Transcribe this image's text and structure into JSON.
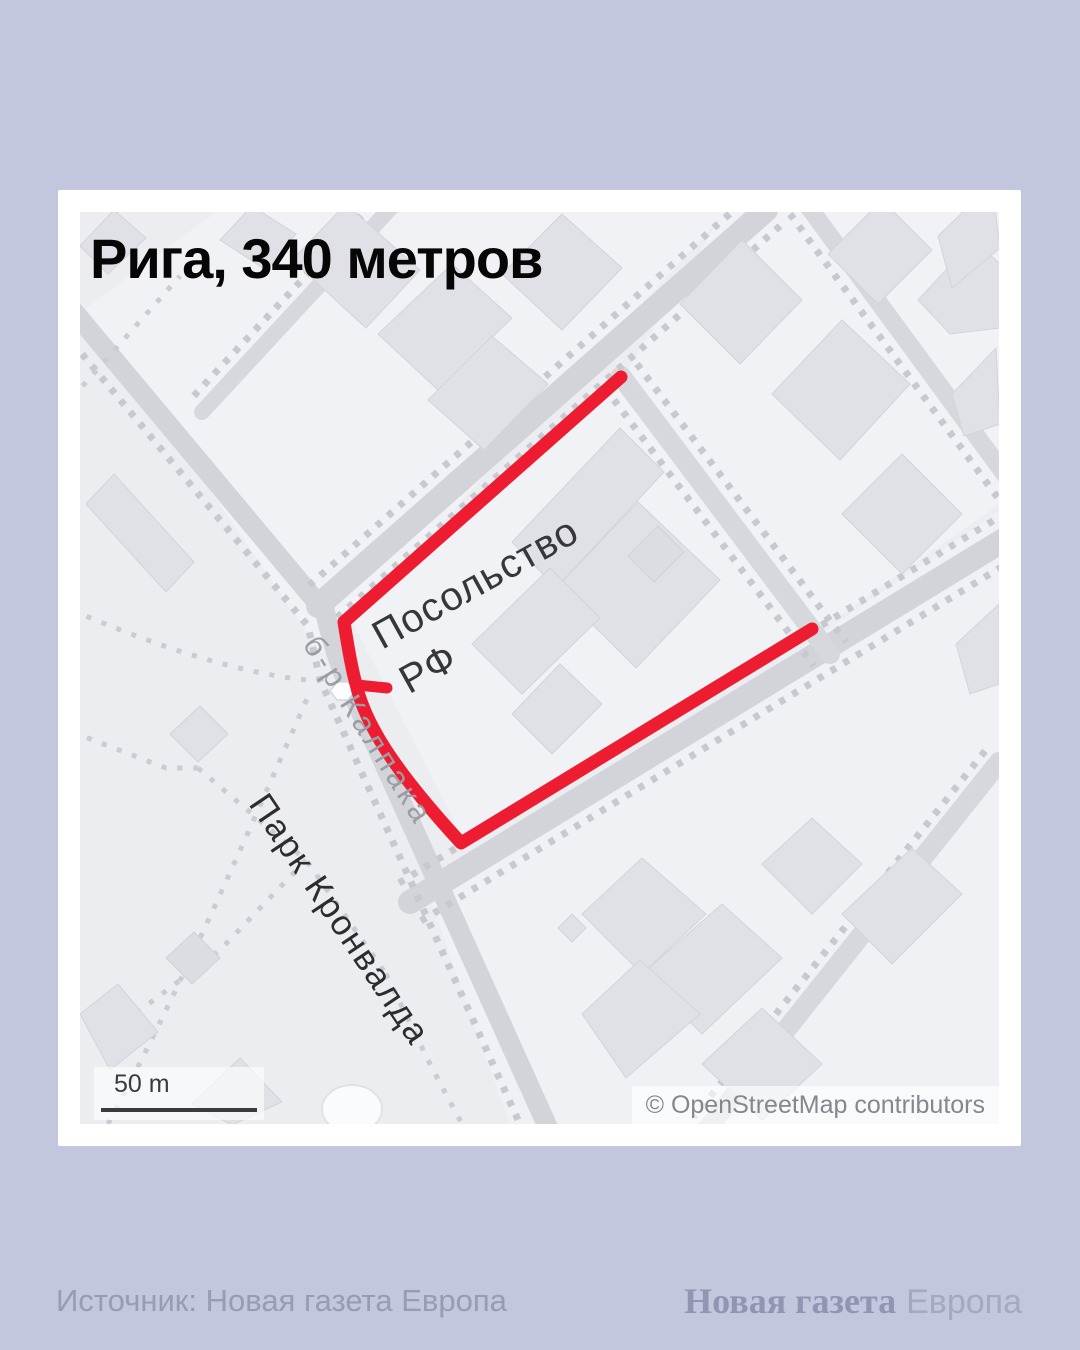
{
  "page": {
    "background_color": "#c3c7dd",
    "card_color": "#ffffff"
  },
  "map": {
    "title": "Рига, 340 метров",
    "labels": {
      "embassy_line1": "Посольство",
      "embassy_line2": "РФ",
      "street": "б-р Калпака",
      "park": "Парк Кронвалда"
    },
    "scale": {
      "label": "50 m"
    },
    "attribution": "© OpenStreetMap contributors",
    "route": {
      "color": "#ed1c30",
      "path_d": "M 541,165 L 264,410 C 269,442 272,458 276,472 C 285,512 314,558 381,631 L 732,417",
      "spur_d": "M 277,473 L 307,476"
    },
    "colors": {
      "base": "#ebedf1",
      "road": "#d2d4da",
      "building": "#dfe1e6",
      "dotted_line": "#c7c9d1",
      "route_red": "#ed1c30"
    }
  },
  "footer": {
    "source": "Источник: Новая газета Европа",
    "logo_bold": "Новая газета",
    "logo_light": "Европа"
  }
}
